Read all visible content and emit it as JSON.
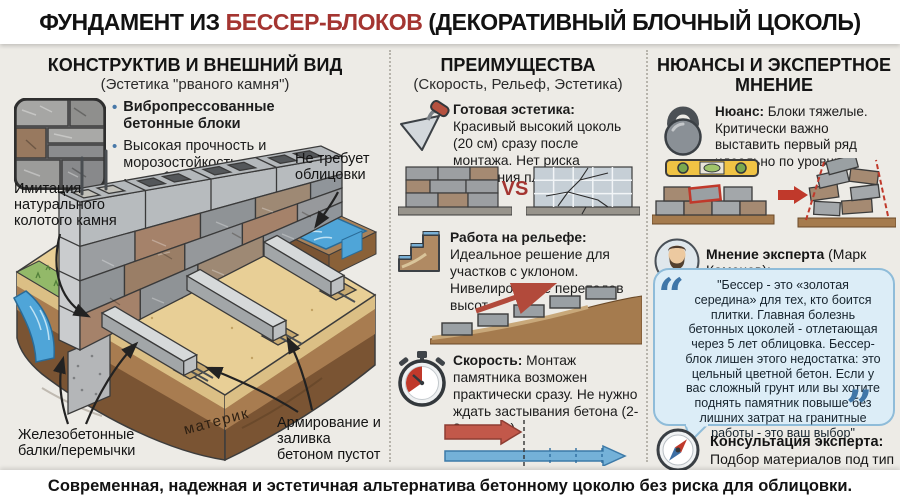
{
  "header": {
    "title_prefix": "ФУНДАМЕНТ ИЗ ",
    "title_highlight": "БЕССЕР-БЛОКОВ",
    "title_suffix": " (ДЕКОРАТИВНЫЙ БЛОЧНЫЙ ЦОКОЛЬ)"
  },
  "left": {
    "title": "КОНСТРУКТИВ И ВНЕШНИЙ ВИД",
    "subtitle": "(Эстетика \"рваного камня\")",
    "swatch_icon": "stone-texture-swatch",
    "bullets": [
      {
        "text": "Вибропрессованные бетонные блоки"
      },
      {
        "text": "Высокая прочность и морозостойкость"
      },
      {
        "text": "Не требует облицовки"
      }
    ],
    "diagram_labels": {
      "stone_imitation": "Имитация натурального колотого камня",
      "no_cladding": "Не требует облицовки",
      "beams": "Железобетонные балки/перемычки",
      "bedrock": "материк",
      "reinforcement": "Армирование и заливка бетоном пустот"
    }
  },
  "middle": {
    "title": "ПРЕИМУЩЕСТВА",
    "subtitle": "(Скорость, Рельеф, Эстетика)",
    "vs_label": "VS",
    "features": [
      {
        "icon": "trowel-icon",
        "label": "Готовая эстетика:",
        "text": "Красивый высокий цоколь (20 см) сразу после монтажа. Нет риска отпадания плитки"
      },
      {
        "icon": "terrain-steps-icon",
        "label": "Работа на рельефе:",
        "text": "Идеальное решение для участков с уклоном. Нивелирование перепадов высот"
      },
      {
        "icon": "stopwatch-icon",
        "label": "Скорость:",
        "text": "Монтаж памятника возможен практически сразу. Не нужно ждать застывания бетона (2-3 недели)"
      }
    ]
  },
  "right": {
    "title": "НЮАНСЫ И ЭКСПЕРТНОЕ МНЕНИЕ",
    "nuance": {
      "icon": "kettlebell-icon",
      "label": "Нюанс:",
      "text": "Блоки тяжелые. Критически важно выставить первый ряд идеально по уровню"
    },
    "expert": {
      "icon": "expert-avatar",
      "label": "Мнение эксперта",
      "name_suffix": " (Марк Каменев):",
      "quote": "\"Бессер - это «золотая середина» для тех, кто боится плитки. Главная болезнь бетонных цоколей - отлетающая через 5 лет облицовка. Бессер-блок лишен этого недостатка: это цельный цветной бетон. Если у вас сложный грунт или вы хотите поднять памятник повыше без лишних затрат на гранитные работы - это ваш выбор\""
    },
    "consultation": {
      "icon": "compass-icon",
      "label": "Консультация эксперта:",
      "text": "Подбор материалов под тип почвы"
    }
  },
  "footer": {
    "text": "Современная, надежная и эстетичная альтернатива бетонному цоколю без риска для облицовки."
  },
  "colors": {
    "accent_red": "#a43531",
    "bullet_blue": "#4878a8",
    "bubble_bg": "#dcedf7",
    "bubble_border": "#8fbcd9",
    "quote_blue": "#3f76a8",
    "background": "#edebe6",
    "panel_white": "#ffffff",
    "sand": "#e8cf96",
    "soil": "#a87c50",
    "water": "#4fa5d8",
    "grass": "#93b969"
  }
}
